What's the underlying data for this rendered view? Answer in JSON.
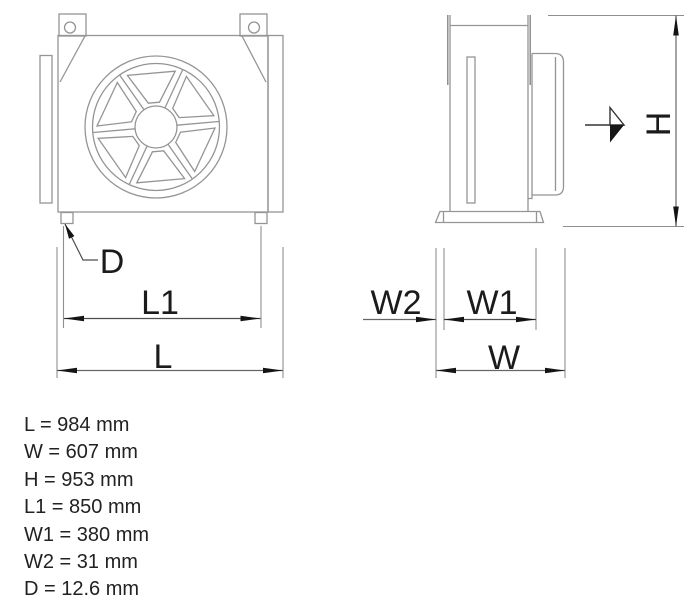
{
  "drawing_title": "Fan cooler dimension drawing",
  "dim_labels": {
    "d": "D",
    "l1": "L1",
    "l": "L",
    "w2": "W2",
    "w1": "W1",
    "w": "W",
    "h": "H"
  },
  "spec_list": {
    "items": [
      {
        "name": "L",
        "value": "984",
        "unit": "mm",
        "text": "L = 984 mm"
      },
      {
        "name": "W",
        "value": "607",
        "unit": "mm",
        "text": "W = 607 mm"
      },
      {
        "name": "H",
        "value": "953",
        "unit": "mm",
        "text": "H = 953 mm"
      },
      {
        "name": "L1",
        "value": "850",
        "unit": "mm",
        "text": "L1 = 850 mm"
      },
      {
        "name": "W1",
        "value": "380",
        "unit": "mm",
        "text": "W1 = 380 mm"
      },
      {
        "name": "W2",
        "value": "31",
        "unit": "mm",
        "text": "W2 = 31 mm"
      },
      {
        "name": "D",
        "value": "12.6",
        "unit": "mm",
        "text": "D = 12.6 mm"
      }
    ]
  },
  "colors": {
    "background": "#ffffff",
    "outline": "#959595",
    "extension_line": "#8f8f8f",
    "dimension_line": "#666666",
    "ink": "#1b1b1b"
  }
}
